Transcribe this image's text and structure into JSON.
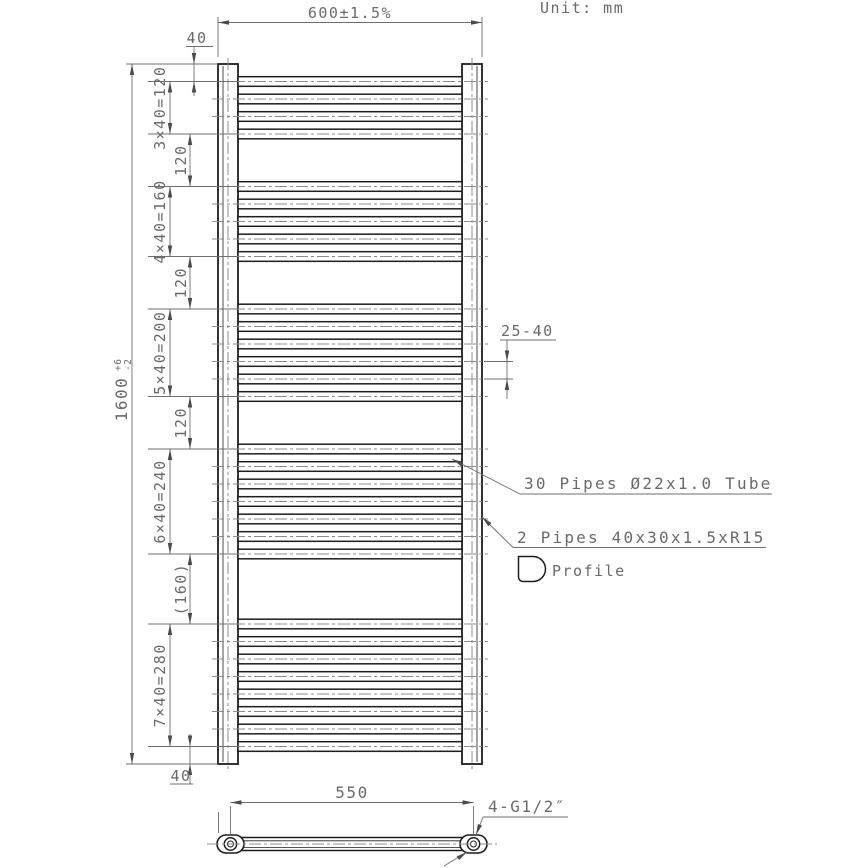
{
  "meta": {
    "unit_label": "Unit: mm"
  },
  "drawing": {
    "colors": {
      "line_dark": "#1d1d1d",
      "line_thin": "#6f6f6f",
      "centerline": "#8c8c8c",
      "text": "#6a6a6a",
      "arrow": "#4a4a4a"
    },
    "structure": {
      "total_pipes": 30,
      "pipe_groups": [
        4,
        5,
        6,
        7,
        8
      ],
      "pipe_pitch_mm": 40,
      "group_gaps_mm": [
        120,
        120,
        120,
        160
      ],
      "end_offset_mm": 40,
      "height_mm": 1600,
      "width_mm": 600,
      "pipe_od_mm": 22,
      "port_spacing_mm": 550,
      "port_count": 4
    }
  },
  "dimensions": {
    "width": "600±1.5%",
    "height_main": "1600",
    "height_tol_plus": "+6",
    "height_tol_minus": "-2",
    "top_offset": "40",
    "bottom_offset": "40",
    "group_labels": [
      "3×40=120",
      "4×40=160",
      "5×40=200",
      "6×40=240",
      "7×40=280"
    ],
    "gap_labels": [
      "120",
      "120",
      "120",
      "(160)"
    ],
    "pipe_gap": "25-40",
    "port_spacing": "550",
    "port_label": "4-G1/2″"
  },
  "annotations": {
    "round_pipes": "30 Pipes Ø22x1.0 Tube",
    "square_pipes": "2 Pipes 40x30x1.5xR15",
    "profile_label": "Profile"
  }
}
